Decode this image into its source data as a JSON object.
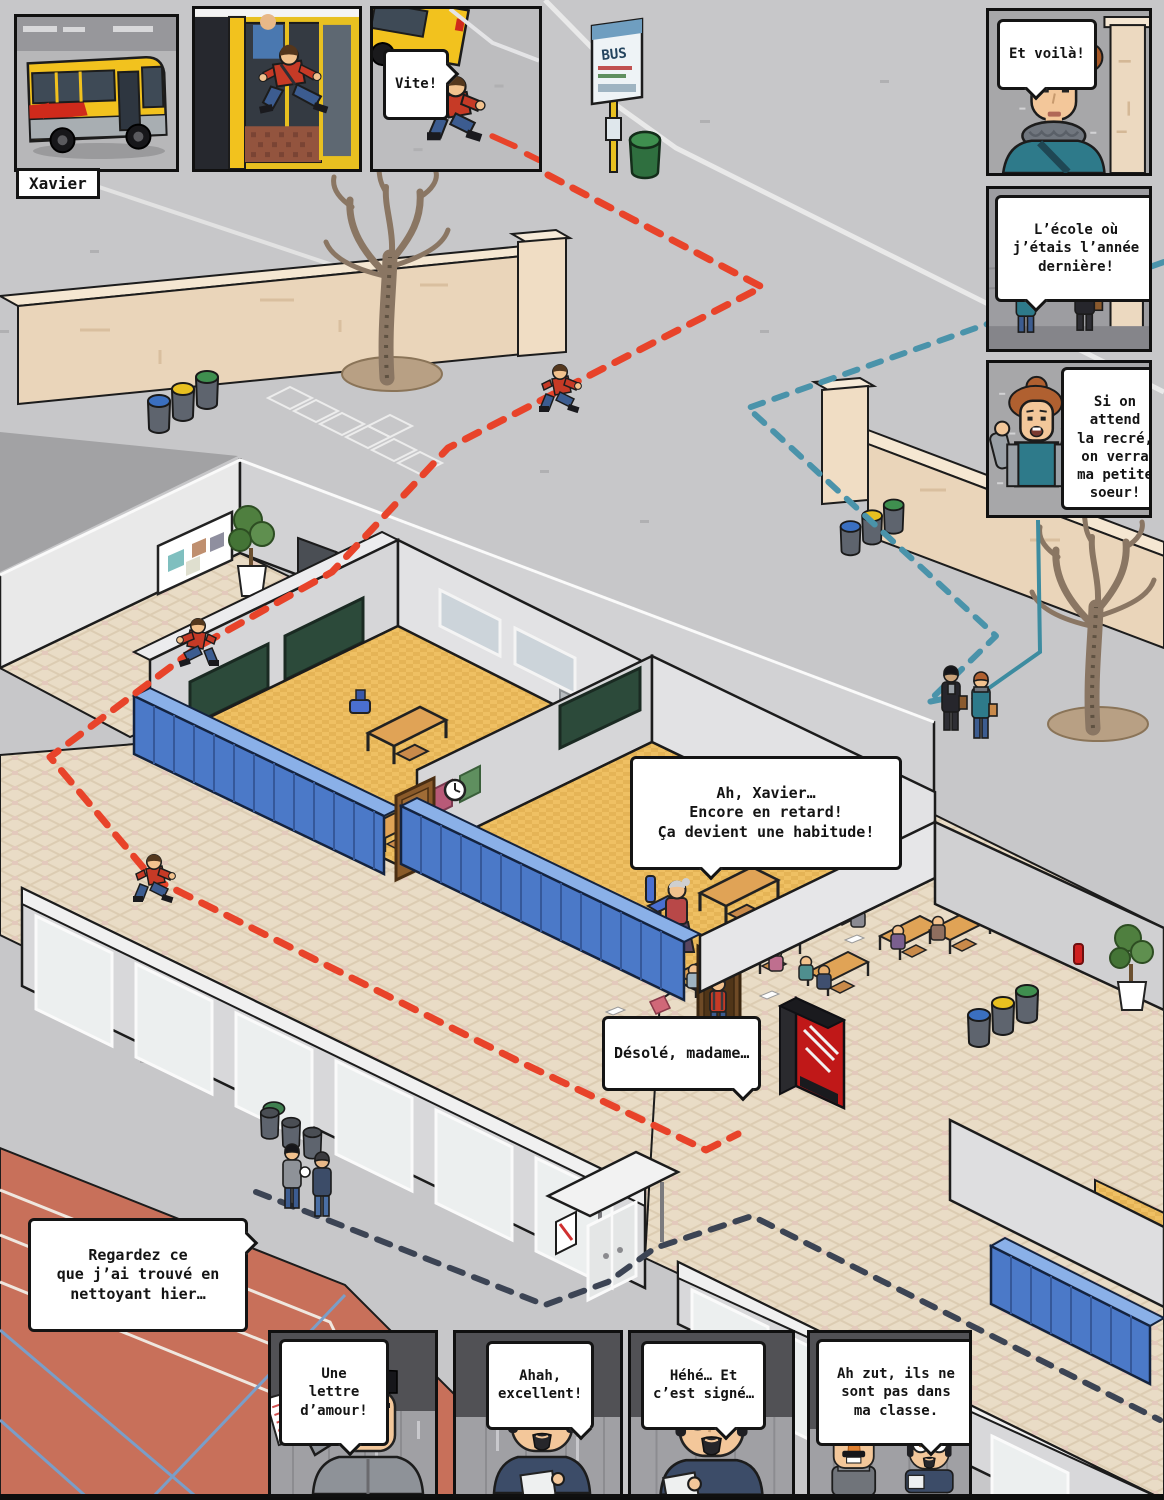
{
  "comic": {
    "bus_panel": {
      "caption": "Xavier",
      "bus_logo": "TEC"
    },
    "vite_panel": {
      "bubble": "Vite!"
    },
    "et_voila_panel": {
      "bubble": "Et voilà!"
    },
    "ecole_panel": {
      "bubble": "L’école où\nj’étais l’année\ndernière!"
    },
    "recre_panel": {
      "bubble": "Si on\nattend\nla recré,\non verra\nma petite\nsoeur!"
    },
    "lettre_panel": {
      "bubble": "Une\nlettre\nd’amour!"
    },
    "excellent_panel": {
      "bubble": "Ahah,\nexcellent!"
    },
    "signe_panel": {
      "bubble": "Héhé… Et\nc’est signé…"
    },
    "classe_panel": {
      "bubble": "Ah zut, ils ne\nsont pas dans\nma classe."
    }
  },
  "scene": {
    "bubbles": {
      "retard": "Ah, Xavier…\nEncore en retard!\nÇa devient une habitude!",
      "desole": "Désolé, madame…",
      "regardez": "Regardez ce\nque j’ai trouvé en\nnettoyant hier…"
    },
    "bus_stop_sign": "BUS",
    "colors": {
      "xavier_path_red": "#e8432a",
      "sister_path_teal": "#4a93aa",
      "janitor_path_navy": "#3c4454",
      "bus_yellow": "#f2c21e",
      "bus_red": "#cf2a1b",
      "locker_blue": "#4b79c8",
      "classroom_floor": "#efc063",
      "corridor_tile": "#e9dcc6",
      "wall_beige": "#ead5ba",
      "track_red": "#c8705a",
      "vending_red": "#c01818"
    }
  }
}
